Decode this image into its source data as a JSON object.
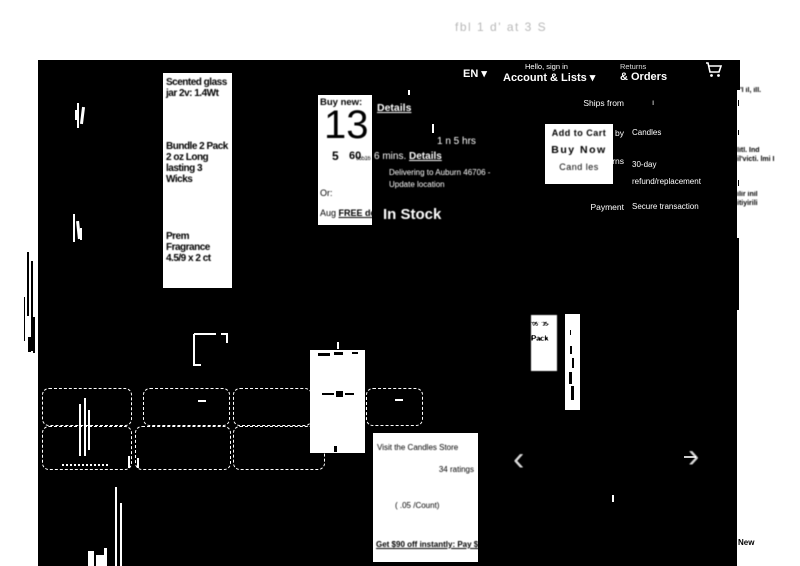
{
  "topbar": {
    "title": "fbl  1 d' at   3 S",
    "dots": "-  ··  -"
  },
  "nav": {
    "language": "EN ▾",
    "signin_small": "Hello, sign in",
    "signin_bold": "Account & Lists ▾",
    "returns_small": "Returns",
    "returns_bold": "& Orders"
  },
  "product": {
    "title_block1": "Scented glass jar 2v: 1.4Wt",
    "title_block2": "Bundle 2 Pack 2 oz Long lasting 3 Wicks",
    "title_block3": "Prem Fragrance 4.5/9 x 2 ct"
  },
  "buybox": {
    "buy_new_label": "Buy new:",
    "price_whole": "13",
    "frac_a": "5",
    "frac_b": "60",
    "frac_tiny": "55516",
    "or_label": "Or:",
    "free_prefix": "Aug ",
    "free_label": "FREE del",
    "details_top": "Details"
  },
  "delivery": {
    "hrs_fragment": "1 n    5 hrs",
    "mins_prefix": "6 mins. ",
    "mins_link": "Details",
    "delivering_line1": "Delivering to Auburn 46706 -",
    "delivering_line2": "Update location",
    "in_stock": "In Stock"
  },
  "purchase": {
    "rows": [
      {
        "label": "Ships from",
        "value": "ı"
      },
      {
        "label": "Sold by",
        "value": "Candles"
      },
      {
        "label": "Returns",
        "value": "30-day refund/replacement"
      },
      {
        "label": "Payment",
        "value": "Secure transaction"
      }
    ],
    "add_to_cart": "Add to Cart",
    "buy_now": "Buy Now",
    "seller_link": "Cand les"
  },
  "variations": {
    "price_tile_line1": "'05' '35-",
    "price_tile_line2": "Pack"
  },
  "info_card": {
    "store_link": "Visit the Candles Store",
    "ratings": "34 ratings",
    "unit_price": "( .05  /Count)",
    "promo": "Get $90 off instantly: Pay $0.00"
  },
  "carousel": {
    "prev": "‹",
    "next": "›"
  },
  "margin": {
    "frag1": "'l il, ill.",
    "frag2": "litl. Ind il'victi. lmi I",
    "frag3": "ilir inil itiyirili",
    "condition": "New"
  },
  "colors": {
    "background": "#000000",
    "foreground": "#ffffff",
    "page": "#ffffff",
    "title_gray": "#999999"
  }
}
